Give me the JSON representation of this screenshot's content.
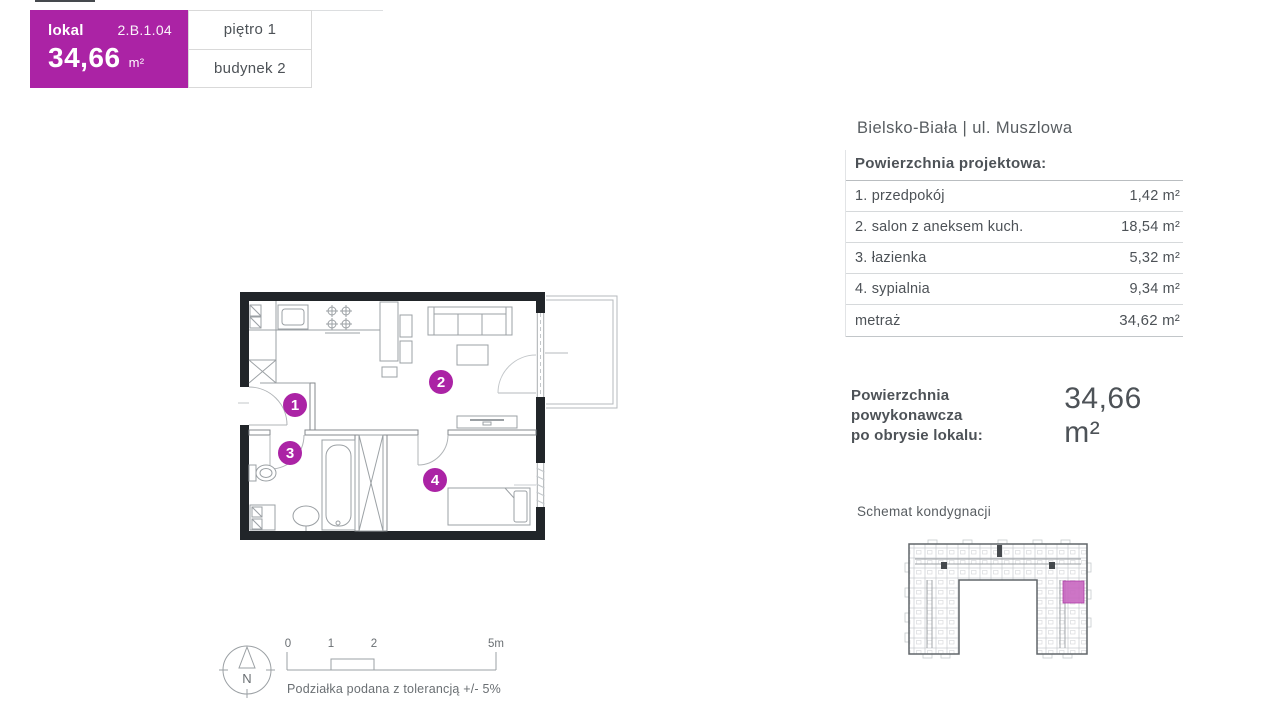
{
  "badge": {
    "lokal_label": "lokal",
    "unit_number": "2.B.1.04",
    "area_value": "34,66",
    "area_unit": "m²",
    "floor_label": "piętro 1",
    "building_label": "budynek 2"
  },
  "location_title": "Bielsko-Biała | ul. Muszlowa",
  "area_table": {
    "header": "Powierzchnia projektowa:",
    "rows": [
      {
        "label": "1. przedpokój",
        "value": "1,42 m²"
      },
      {
        "label": "2. salon z aneksem kuch.",
        "value": "18,54 m²"
      },
      {
        "label": "3. łazienka",
        "value": "5,32 m²"
      },
      {
        "label": "4. sypialnia",
        "value": "9,34 m²"
      }
    ],
    "total_label": "metraż",
    "total_value": "34,62 m²"
  },
  "as_built": {
    "label_line1": "Powierzchnia powykonawcza",
    "label_line2": "po obrysie lokalu:",
    "value": "34,66 m²"
  },
  "floor_schematic": {
    "title": "Schemat kondygnacji"
  },
  "floor_plan": {
    "room_labels": [
      "1",
      "2",
      "3",
      "4"
    ]
  },
  "compass": {
    "north_label": "N"
  },
  "scale_bar": {
    "ticks": [
      "0",
      "1",
      "2",
      "5m"
    ],
    "tolerance_note": "Podziałka podana z tolerancją +/- 5%"
  },
  "colors": {
    "accent": "#ab23a5",
    "accent_light": "#c867c0",
    "text_dark": "#4d5257",
    "text_mid": "#6a6f73",
    "plan_wall": "#212529",
    "plan_line": "#9ba0a4"
  }
}
